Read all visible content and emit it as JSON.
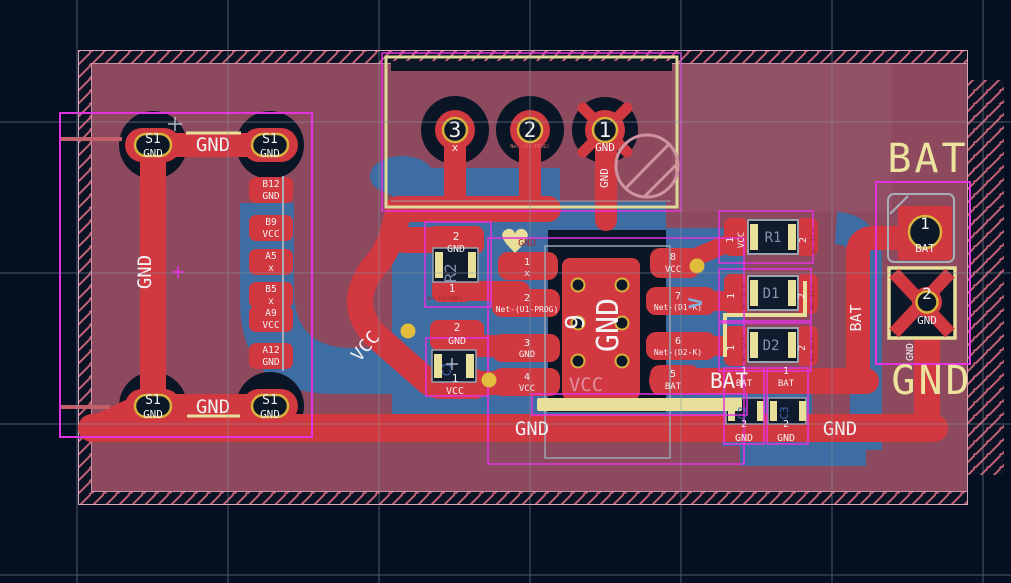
{
  "app": {
    "description": "PCB layout editor canvas"
  },
  "colors": {
    "background": "#041022",
    "board": "#8d4a5e",
    "copper_front": "#d23840",
    "copper_back": "#3e6da3",
    "silkscreen": "#e8e09a",
    "courtyard": "#e332e0",
    "gold_ring": "#d8b23c",
    "hole": "#0c1828",
    "label": "#f2f2f2"
  },
  "left_connector": {
    "mount_pads": [
      {
        "ref": "S1",
        "net": "GND"
      },
      {
        "ref": "S1",
        "net": "GND"
      },
      {
        "ref": "S1",
        "net": "GND"
      },
      {
        "ref": "S1",
        "net": "GND"
      }
    ],
    "pin_pads": [
      {
        "pin": "B12",
        "net": "GND"
      },
      {
        "pin": "B9",
        "net": "VCC"
      },
      {
        "pin": "A5",
        "net": "x"
      },
      {
        "pin": "B5",
        "net": "x"
      },
      {
        "pin": "A9",
        "net": "VCC"
      },
      {
        "pin": "A12",
        "net": "GND"
      }
    ],
    "top_trace_label": "GND",
    "left_trace_label": "GND",
    "bottom_trace_label": "GND"
  },
  "prog_connector": {
    "pad3_num": "3",
    "pad3_net": "x",
    "pad2_num": "2",
    "pad2_net": "Net-(U1-PROG)",
    "pad1_num": "1",
    "pad1_net": "GND",
    "pad1_trace_label": "GND"
  },
  "ic": {
    "center_pad_num": "9",
    "center_pad_net": "GND",
    "left_pads": [
      {
        "num": "1",
        "net": "x"
      },
      {
        "num": "2",
        "net": "Net-(U1-PROG)"
      },
      {
        "num": "3",
        "net": "GND"
      },
      {
        "num": "4",
        "net": "VCC"
      }
    ],
    "right_pads": [
      {
        "num": "8",
        "net": "VCC"
      },
      {
        "num": "7",
        "net": "Net-(D1-K)"
      },
      {
        "num": "6",
        "net": "Net-(D2-K)"
      },
      {
        "num": "5",
        "net": "BAT"
      }
    ],
    "silk_vcc_label": "VCC",
    "hidden_gnd_label": "GND",
    "back_copper_label": "V"
  },
  "r2": {
    "ref": "R2",
    "pad2_num": "2",
    "pad2_net": "GND",
    "pad1_num": "1",
    "pad1_net": "Net-[U1-PROG]"
  },
  "c1": {
    "ref": "C1",
    "pad2_num": "2",
    "pad2_net": "GND",
    "pad1_num": "1",
    "pad1_net": "VCC"
  },
  "r1": {
    "ref": "R1",
    "pad1_num": "1",
    "pad1_net": "VCC",
    "pad2_num": "2",
    "pad2_net": "Net-(D1-A)"
  },
  "d1": {
    "ref": "D1",
    "pad1_num": "1",
    "pad1_net": "Net-(D1-K)",
    "pad2_num": "2",
    "pad2_net": "Net-(D1-A)"
  },
  "d2": {
    "ref": "D2",
    "pad1_num": "1",
    "pad1_net": "Net-(D2-K)",
    "pad2_num": "2",
    "pad2_net": "Net-(D2-A)"
  },
  "bottom_caps": [
    {
      "ref": "C2",
      "top_num": "1",
      "top_net": "BAT",
      "bottom_num": "2",
      "bottom_net": "GND"
    },
    {
      "ref": "C3",
      "top_num": "1",
      "top_net": "BAT",
      "bottom_num": "2",
      "bottom_net": "GND"
    }
  ],
  "bat_connector": {
    "title": "BAT",
    "footer": "GND",
    "pad1_num": "1",
    "pad1_net": "BAT",
    "pad2_num": "2",
    "pad2_net": "GND",
    "pad2_trace_label": "GND"
  },
  "trace_labels": {
    "vcc_diag": "VCC",
    "gnd_long": "GND",
    "gnd_right": "GND",
    "bat_big": "BAT",
    "bat_vertical": "BAT"
  }
}
